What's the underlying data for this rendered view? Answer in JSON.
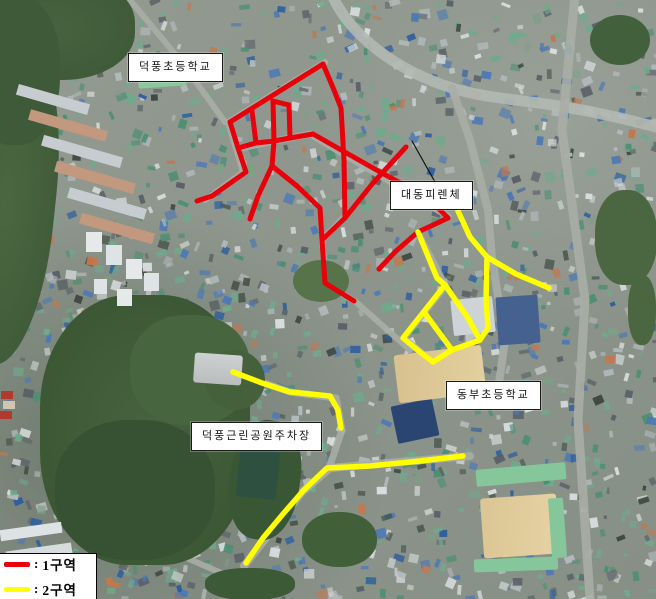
{
  "map": {
    "labels": [
      {
        "id": "deokpung-elementary-school",
        "text": "덕풍초등학교",
        "x": 128,
        "y": 53
      },
      {
        "id": "daedong-firenze",
        "text": "대동피렌체",
        "x": 390,
        "y": 181
      },
      {
        "id": "dongbu-elementary-school",
        "text": "동부초등학교",
        "x": 446,
        "y": 381
      },
      {
        "id": "deokpung-park-parking",
        "text": "덕풍근린공원주차장",
        "x": 191,
        "y": 422
      }
    ],
    "legend_separator": ":",
    "legend": [
      {
        "label": "1구역",
        "color": "#e8000a"
      },
      {
        "label": "2구역",
        "color": "#ffff00"
      }
    ],
    "leader_line": {
      "color": "#111111",
      "points": [
        [
          412,
          141
        ],
        [
          435,
          182
        ]
      ]
    },
    "zones": {
      "zone1": {
        "name": "1구역",
        "color": "#e8000a",
        "stroke_width": 5,
        "polylines": [
          [
            [
              323,
              64
            ],
            [
              230,
              122
            ]
          ],
          [
            [
              323,
              64
            ],
            [
              334,
              90
            ],
            [
              341,
              108
            ],
            [
              344,
              160
            ],
            [
              345,
              218
            ]
          ],
          [
            [
              406,
              147
            ],
            [
              373,
              183
            ],
            [
              345,
              218
            ]
          ],
          [
            [
              345,
              218
            ],
            [
              322,
              240
            ],
            [
              325,
              283
            ],
            [
              354,
              301
            ]
          ],
          [
            [
              230,
              122
            ],
            [
              238,
              148
            ],
            [
              246,
              172
            ],
            [
              212,
              196
            ],
            [
              197,
              201
            ]
          ],
          [
            [
              238,
              148
            ],
            [
              256,
              143
            ],
            [
              274,
              141
            ],
            [
              290,
              138
            ],
            [
              313,
              134
            ]
          ],
          [
            [
              313,
              134
            ],
            [
              380,
              172
            ],
            [
              428,
              198
            ],
            [
              448,
              218
            ]
          ],
          [
            [
              448,
              218
            ],
            [
              418,
              232
            ],
            [
              396,
              251
            ],
            [
              379,
              269
            ]
          ],
          [
            [
              252,
              111
            ],
            [
              256,
              143
            ]
          ],
          [
            [
              273,
              101
            ],
            [
              274,
              141
            ]
          ],
          [
            [
              289,
              105
            ],
            [
              290,
              138
            ]
          ],
          [
            [
              273,
              101
            ],
            [
              289,
              105
            ]
          ],
          [
            [
              274,
              141
            ],
            [
              272,
              166
            ],
            [
              297,
              186
            ],
            [
              320,
              208
            ],
            [
              322,
              240
            ]
          ],
          [
            [
              272,
              166
            ],
            [
              258,
              196
            ],
            [
              250,
              219
            ]
          ]
        ]
      },
      "zone2": {
        "name": "2구역",
        "color": "#ffff00",
        "stroke_width": 5.5,
        "polylines": [
          [
            [
              458,
              211
            ],
            [
              470,
              237
            ],
            [
              487,
              257
            ]
          ],
          [
            [
              487,
              257
            ],
            [
              516,
              274
            ],
            [
              549,
              288
            ]
          ],
          [
            [
              487,
              257
            ],
            [
              486,
              300
            ],
            [
              488,
              328
            ],
            [
              480,
              340
            ],
            [
              452,
              350
            ],
            [
              433,
              362
            ]
          ],
          [
            [
              418,
              232
            ],
            [
              437,
              278
            ],
            [
              445,
              285
            ]
          ],
          [
            [
              445,
              285
            ],
            [
              403,
              338
            ],
            [
              420,
              352
            ],
            [
              433,
              362
            ]
          ],
          [
            [
              424,
              312
            ],
            [
              452,
              350
            ]
          ],
          [
            [
              445,
              285
            ],
            [
              468,
              318
            ],
            [
              480,
              340
            ]
          ],
          [
            [
              233,
              372
            ],
            [
              262,
              383
            ],
            [
              290,
              392
            ],
            [
              330,
              396
            ],
            [
              338,
              410
            ],
            [
              341,
              428
            ]
          ],
          [
            [
              463,
              456
            ],
            [
              420,
              461
            ],
            [
              370,
              466
            ],
            [
              327,
              468
            ],
            [
              303,
              491
            ],
            [
              283,
              514
            ],
            [
              263,
              538
            ],
            [
              246,
              563
            ]
          ]
        ]
      }
    }
  }
}
